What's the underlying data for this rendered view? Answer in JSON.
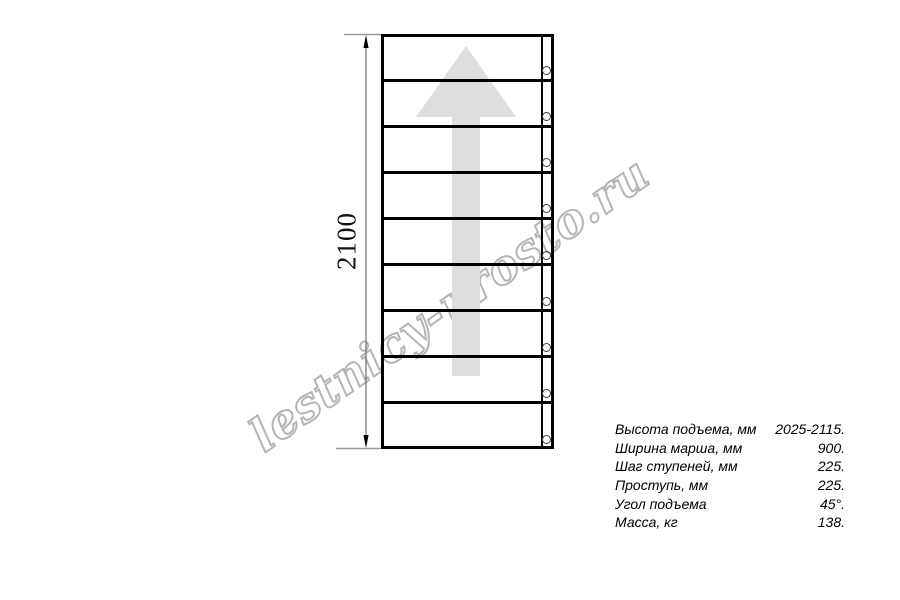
{
  "watermark": {
    "text": "lestnicy-prosto.ru",
    "color": "#b5b5b5"
  },
  "diagram": {
    "dimension_label": "2100",
    "step_lines": 8,
    "screws": 9,
    "arrow_color": "#dedede",
    "line_color": "#000000"
  },
  "specs": {
    "rows": [
      {
        "label": "Высота подъема, мм",
        "value": "2025-2115."
      },
      {
        "label": "Ширина марша, мм",
        "value": "900."
      },
      {
        "label": "Шаг ступеней, мм",
        "value": "225."
      },
      {
        "label": "Проступь, мм",
        "value": "225."
      },
      {
        "label": "Угол подъема",
        "value": "45°."
      },
      {
        "label": "Масса, кг",
        "value": "138."
      }
    ]
  }
}
